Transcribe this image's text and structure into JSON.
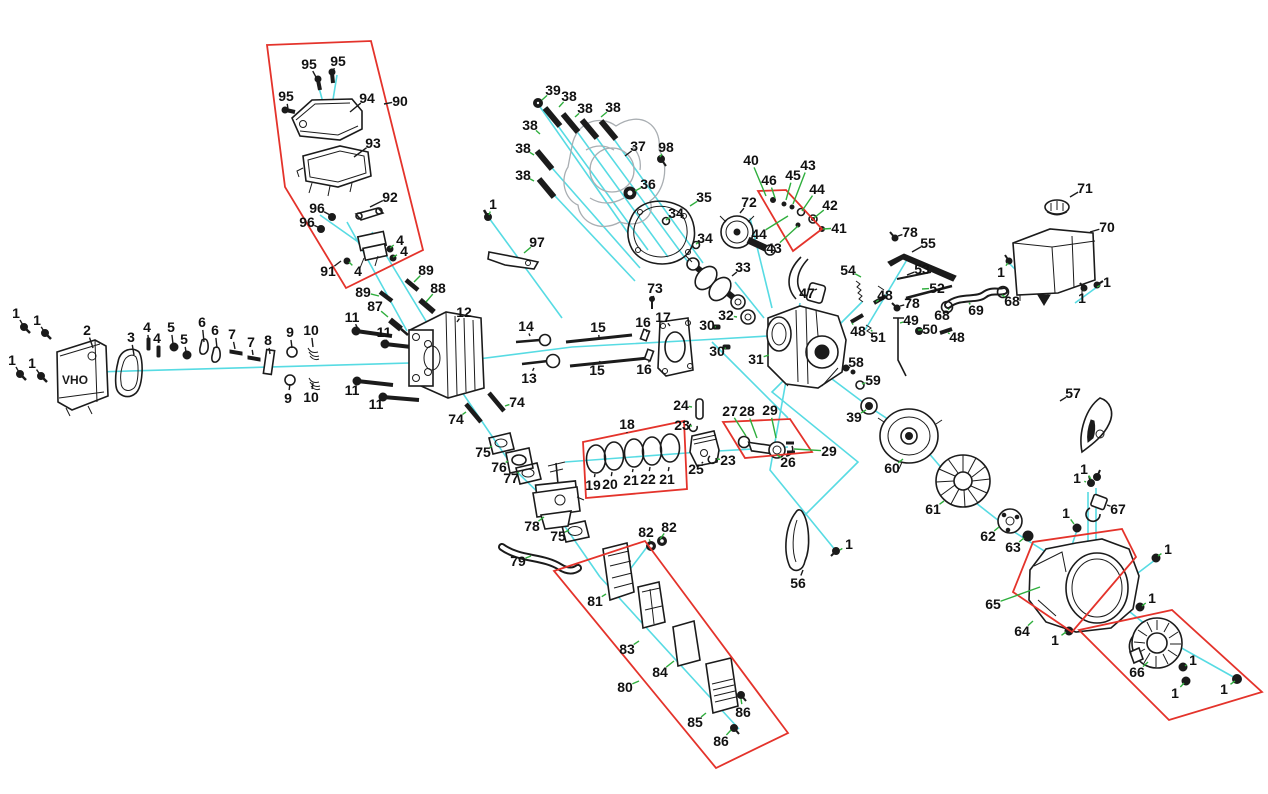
{
  "canvas": {
    "width": 1268,
    "height": 794,
    "background": "#ffffff"
  },
  "colors": {
    "leader_green": "#2fae3d",
    "leader_black": "#1b1b1b",
    "axis_cyan": "#57dbe3",
    "group_red": "#e4332b",
    "label_ink": "#111111"
  },
  "muffler_text": "OHV",
  "labels": [
    {
      "t": "1",
      "x": 16,
      "y": 313,
      "lx": 24,
      "ly": 327,
      "c": "k"
    },
    {
      "t": "1",
      "x": 37,
      "y": 320,
      "lx": 45,
      "ly": 333,
      "c": "k"
    },
    {
      "t": "1",
      "x": 12,
      "y": 360,
      "lx": 20,
      "ly": 374,
      "c": "k"
    },
    {
      "t": "1",
      "x": 32,
      "y": 363,
      "lx": 41,
      "ly": 376,
      "c": "k"
    },
    {
      "t": "2",
      "x": 87,
      "y": 330,
      "lx": 93,
      "ly": 348,
      "c": "k"
    },
    {
      "t": "3",
      "x": 131,
      "y": 337,
      "lx": 134,
      "ly": 355,
      "c": "k"
    },
    {
      "t": "4",
      "x": 147,
      "y": 327,
      "lx": 149,
      "ly": 344,
      "c": "k"
    },
    {
      "t": "4",
      "x": 157,
      "y": 338,
      "lx": 159,
      "ly": 352,
      "c": "k"
    },
    {
      "t": "5",
      "x": 171,
      "y": 327,
      "lx": 173,
      "ly": 344,
      "c": "k"
    },
    {
      "t": "5",
      "x": 184,
      "y": 339,
      "lx": 186,
      "ly": 352,
      "c": "k"
    },
    {
      "t": "6",
      "x": 202,
      "y": 322,
      "lx": 204,
      "ly": 342,
      "c": "k"
    },
    {
      "t": "6",
      "x": 215,
      "y": 330,
      "lx": 217,
      "ly": 348,
      "c": "k"
    },
    {
      "t": "7",
      "x": 232,
      "y": 334,
      "lx": 235,
      "ly": 349,
      "c": "k"
    },
    {
      "t": "7",
      "x": 251,
      "y": 342,
      "lx": 253,
      "ly": 355,
      "c": "k"
    },
    {
      "t": "8",
      "x": 268,
      "y": 340,
      "lx": 270,
      "ly": 354,
      "c": "k"
    },
    {
      "t": "9",
      "x": 290,
      "y": 332,
      "lx": 292,
      "ly": 348,
      "c": "k"
    },
    {
      "t": "9",
      "x": 288,
      "y": 398,
      "lx": 290,
      "ly": 384,
      "c": "k"
    },
    {
      "t": "10",
      "x": 311,
      "y": 330,
      "lx": 313,
      "ly": 347,
      "c": "k"
    },
    {
      "t": "10",
      "x": 311,
      "y": 397,
      "lx": 313,
      "ly": 383,
      "c": "k"
    },
    {
      "t": "11",
      "x": 352,
      "y": 317,
      "lx": 358,
      "ly": 329,
      "c": "k"
    },
    {
      "t": "11",
      "x": 384,
      "y": 332,
      "lx": 387,
      "ly": 342,
      "c": "k"
    },
    {
      "t": "11",
      "x": 352,
      "y": 390,
      "lx": 359,
      "ly": 382,
      "c": "k"
    },
    {
      "t": "11",
      "x": 376,
      "y": 404,
      "lx": 382,
      "ly": 397,
      "c": "k"
    },
    {
      "t": "87",
      "x": 375,
      "y": 306,
      "lx": 388,
      "ly": 317
    },
    {
      "t": "89",
      "x": 363,
      "y": 292,
      "lx": 379,
      "ly": 296
    },
    {
      "t": "89",
      "x": 426,
      "y": 270,
      "lx": 414,
      "ly": 282
    },
    {
      "t": "88",
      "x": 438,
      "y": 288,
      "lx": 426,
      "ly": 302
    },
    {
      "t": "95",
      "x": 309,
      "y": 64,
      "lx": 317,
      "ly": 79,
      "c": "k"
    },
    {
      "t": "95",
      "x": 338,
      "y": 61,
      "lx": 332,
      "ly": 73,
      "c": "k"
    },
    {
      "t": "95",
      "x": 286,
      "y": 96,
      "lx": 288,
      "ly": 109,
      "c": "k"
    },
    {
      "t": "94",
      "x": 367,
      "y": 98,
      "lx": 350,
      "ly": 112,
      "c": "k"
    },
    {
      "t": "90",
      "x": 400,
      "y": 101,
      "lx": 384,
      "ly": 104,
      "c": "k"
    },
    {
      "t": "93",
      "x": 373,
      "y": 143,
      "lx": 354,
      "ly": 157,
      "c": "k"
    },
    {
      "t": "92",
      "x": 390,
      "y": 197,
      "lx": 370,
      "ly": 207,
      "c": "k"
    },
    {
      "t": "96",
      "x": 317,
      "y": 208,
      "lx": 330,
      "ly": 215,
      "c": "k"
    },
    {
      "t": "96",
      "x": 307,
      "y": 222,
      "lx": 320,
      "ly": 228,
      "c": "k"
    },
    {
      "t": "91",
      "x": 328,
      "y": 271,
      "lx": 341,
      "ly": 261,
      "c": "k"
    },
    {
      "t": "4",
      "x": 400,
      "y": 240,
      "lx": 390,
      "ly": 248
    },
    {
      "t": "4",
      "x": 404,
      "y": 251,
      "lx": 393,
      "ly": 257
    },
    {
      "t": "4",
      "x": 358,
      "y": 271,
      "lx": 349,
      "ly": 262
    },
    {
      "t": "1",
      "x": 493,
      "y": 204,
      "lx": 489,
      "ly": 215
    },
    {
      "t": "97",
      "x": 537,
      "y": 242,
      "lx": 524,
      "ly": 253
    },
    {
      "t": "39",
      "x": 553,
      "y": 90,
      "lx": 542,
      "ly": 100
    },
    {
      "t": "38",
      "x": 569,
      "y": 96,
      "lx": 559,
      "ly": 107
    },
    {
      "t": "38",
      "x": 585,
      "y": 108,
      "lx": 575,
      "ly": 117
    },
    {
      "t": "38",
      "x": 613,
      "y": 107,
      "lx": 601,
      "ly": 117
    },
    {
      "t": "38",
      "x": 530,
      "y": 125,
      "lx": 540,
      "ly": 134
    },
    {
      "t": "38",
      "x": 523,
      "y": 148,
      "lx": 534,
      "ly": 155
    },
    {
      "t": "38",
      "x": 523,
      "y": 175,
      "lx": 534,
      "ly": 181
    },
    {
      "t": "37",
      "x": 638,
      "y": 146,
      "lx": 625,
      "ly": 156,
      "c": "k"
    },
    {
      "t": "98",
      "x": 666,
      "y": 147,
      "lx": 660,
      "ly": 157
    },
    {
      "t": "36",
      "x": 648,
      "y": 184,
      "lx": 635,
      "ly": 191
    },
    {
      "t": "34",
      "x": 676,
      "y": 213,
      "lx": 666,
      "ly": 220
    },
    {
      "t": "34",
      "x": 705,
      "y": 238,
      "lx": 696,
      "ly": 244
    },
    {
      "t": "35",
      "x": 704,
      "y": 197,
      "lx": 690,
      "ly": 206
    },
    {
      "t": "72",
      "x": 749,
      "y": 202,
      "lx": 740,
      "ly": 213,
      "c": "k"
    },
    {
      "t": "40",
      "x": 751,
      "y": 160,
      "lx": 766,
      "ly": 196
    },
    {
      "t": "46",
      "x": 769,
      "y": 180,
      "lx": 775,
      "ly": 198
    },
    {
      "t": "45",
      "x": 793,
      "y": 175,
      "lx": 786,
      "ly": 200
    },
    {
      "t": "43",
      "x": 808,
      "y": 165,
      "lx": 793,
      "ly": 204
    },
    {
      "t": "44",
      "x": 817,
      "y": 189,
      "lx": 802,
      "ly": 211
    },
    {
      "t": "42",
      "x": 830,
      "y": 205,
      "lx": 814,
      "ly": 218
    },
    {
      "t": "41",
      "x": 839,
      "y": 228,
      "lx": 823,
      "ly": 229
    },
    {
      "t": "44",
      "x": 759,
      "y": 234,
      "lx": 788,
      "ly": 216
    },
    {
      "t": "43",
      "x": 774,
      "y": 248,
      "lx": 798,
      "ly": 226
    },
    {
      "t": "33",
      "x": 743,
      "y": 267,
      "lx": 732,
      "ly": 276,
      "c": "k"
    },
    {
      "t": "73",
      "x": 655,
      "y": 288,
      "lx": 653,
      "ly": 299,
      "c": "k"
    },
    {
      "t": "47",
      "x": 807,
      "y": 293,
      "lx": 817,
      "ly": 289,
      "c": "k"
    },
    {
      "t": "32",
      "x": 726,
      "y": 315,
      "lx": 737,
      "ly": 317
    },
    {
      "t": "30",
      "x": 707,
      "y": 325,
      "lx": 716,
      "ly": 327
    },
    {
      "t": "30",
      "x": 717,
      "y": 351,
      "lx": 726,
      "ly": 348
    },
    {
      "t": "31",
      "x": 756,
      "y": 359,
      "lx": 769,
      "ly": 355
    },
    {
      "t": "16",
      "x": 643,
      "y": 322,
      "lx": 647,
      "ly": 332,
      "c": "k"
    },
    {
      "t": "17",
      "x": 663,
      "y": 317,
      "lx": 670,
      "ly": 326,
      "c": "k"
    },
    {
      "t": "16",
      "x": 644,
      "y": 369,
      "lx": 650,
      "ly": 360,
      "c": "k"
    },
    {
      "t": "15",
      "x": 598,
      "y": 327,
      "lx": 599,
      "ly": 337,
      "c": "k"
    },
    {
      "t": "15",
      "x": 597,
      "y": 370,
      "lx": 600,
      "ly": 361,
      "c": "k"
    },
    {
      "t": "14",
      "x": 526,
      "y": 326,
      "lx": 530,
      "ly": 336,
      "c": "k"
    },
    {
      "t": "13",
      "x": 529,
      "y": 378,
      "lx": 534,
      "ly": 368,
      "c": "k"
    },
    {
      "t": "12",
      "x": 464,
      "y": 312,
      "lx": 457,
      "ly": 322,
      "c": "k"
    },
    {
      "t": "74",
      "x": 456,
      "y": 419,
      "lx": 466,
      "ly": 412
    },
    {
      "t": "74",
      "x": 517,
      "y": 402,
      "lx": 505,
      "ly": 406
    },
    {
      "t": "75",
      "x": 483,
      "y": 452,
      "lx": 492,
      "ly": 446
    },
    {
      "t": "76",
      "x": 499,
      "y": 467,
      "lx": 508,
      "ly": 461
    },
    {
      "t": "77",
      "x": 511,
      "y": 478,
      "lx": 519,
      "ly": 472
    },
    {
      "t": "78",
      "x": 532,
      "y": 526,
      "lx": 544,
      "ly": 517
    },
    {
      "t": "75",
      "x": 558,
      "y": 536,
      "lx": 569,
      "ly": 530
    },
    {
      "t": "79",
      "x": 518,
      "y": 561,
      "lx": 531,
      "ly": 556
    },
    {
      "t": "82",
      "x": 646,
      "y": 532,
      "lx": 650,
      "ly": 541
    },
    {
      "t": "82",
      "x": 669,
      "y": 527,
      "lx": 660,
      "ly": 539
    },
    {
      "t": "18",
      "x": 627,
      "y": 424,
      "lx": 627,
      "ly": 433,
      "c": "k"
    },
    {
      "t": "24",
      "x": 681,
      "y": 405,
      "lx": 692,
      "ly": 407
    },
    {
      "t": "23",
      "x": 682,
      "y": 425,
      "lx": 692,
      "ly": 426
    },
    {
      "t": "19",
      "x": 593,
      "y": 485,
      "lx": 595,
      "ly": 474,
      "c": "k"
    },
    {
      "t": "20",
      "x": 610,
      "y": 484,
      "lx": 612,
      "ly": 472,
      "c": "k"
    },
    {
      "t": "21",
      "x": 631,
      "y": 480,
      "lx": 633,
      "ly": 469,
      "c": "k"
    },
    {
      "t": "22",
      "x": 648,
      "y": 479,
      "lx": 650,
      "ly": 467,
      "c": "k"
    },
    {
      "t": "21",
      "x": 667,
      "y": 479,
      "lx": 669,
      "ly": 467,
      "c": "k"
    },
    {
      "t": "25",
      "x": 696,
      "y": 469,
      "lx": 703,
      "ly": 462,
      "c": "k"
    },
    {
      "t": "23",
      "x": 728,
      "y": 460,
      "lx": 717,
      "ly": 459
    },
    {
      "t": "27",
      "x": 730,
      "y": 411,
      "lx": 746,
      "ly": 436
    },
    {
      "t": "28",
      "x": 747,
      "y": 411,
      "lx": 757,
      "ly": 438
    },
    {
      "t": "29",
      "x": 770,
      "y": 410,
      "lx": 776,
      "ly": 438
    },
    {
      "t": "29",
      "x": 829,
      "y": 451,
      "lx": 794,
      "ly": 449
    },
    {
      "t": "26",
      "x": 788,
      "y": 462,
      "lx": 777,
      "ly": 455
    },
    {
      "t": "55",
      "x": 928,
      "y": 243,
      "lx": 912,
      "ly": 252,
      "c": "k"
    },
    {
      "t": "78",
      "x": 910,
      "y": 232,
      "lx": 898,
      "ly": 236,
      "c": "k"
    },
    {
      "t": "54",
      "x": 848,
      "y": 270,
      "lx": 861,
      "ly": 277
    },
    {
      "t": "53",
      "x": 922,
      "y": 269,
      "lx": 907,
      "ly": 275,
      "c": "k"
    },
    {
      "t": "52",
      "x": 937,
      "y": 288,
      "lx": 922,
      "ly": 289
    },
    {
      "t": "48",
      "x": 885,
      "y": 295,
      "lx": 876,
      "ly": 302
    },
    {
      "t": "78",
      "x": 912,
      "y": 303,
      "lx": 900,
      "ly": 306,
      "c": "k"
    },
    {
      "t": "49",
      "x": 911,
      "y": 320,
      "lx": 900,
      "ly": 323
    },
    {
      "t": "50",
      "x": 930,
      "y": 329,
      "lx": 918,
      "ly": 330
    },
    {
      "t": "51",
      "x": 878,
      "y": 337,
      "lx": 871,
      "ly": 330
    },
    {
      "t": "48",
      "x": 858,
      "y": 331,
      "lx": 852,
      "ly": 323
    },
    {
      "t": "48",
      "x": 957,
      "y": 337,
      "lx": 948,
      "ly": 333
    },
    {
      "t": "68",
      "x": 942,
      "y": 315,
      "lx": 949,
      "ly": 309
    },
    {
      "t": "69",
      "x": 976,
      "y": 310,
      "lx": 969,
      "ly": 303
    },
    {
      "t": "68",
      "x": 1012,
      "y": 301,
      "lx": 1002,
      "ly": 295
    },
    {
      "t": "1",
      "x": 1001,
      "y": 272,
      "lx": 1008,
      "ly": 263
    },
    {
      "t": "71",
      "x": 1085,
      "y": 188,
      "lx": 1070,
      "ly": 197,
      "c": "k"
    },
    {
      "t": "70",
      "x": 1107,
      "y": 227,
      "lx": 1090,
      "ly": 232,
      "c": "k"
    },
    {
      "t": "1",
      "x": 1107,
      "y": 282,
      "lx": 1097,
      "ly": 287
    },
    {
      "t": "1",
      "x": 1082,
      "y": 298,
      "lx": 1084,
      "ly": 290
    },
    {
      "t": "57",
      "x": 1073,
      "y": 393,
      "lx": 1060,
      "ly": 401,
      "c": "k"
    },
    {
      "t": "58",
      "x": 856,
      "y": 362,
      "lx": 849,
      "ly": 368,
      "c": "k"
    },
    {
      "t": "59",
      "x": 873,
      "y": 380,
      "lx": 862,
      "ly": 384
    },
    {
      "t": "39",
      "x": 854,
      "y": 417,
      "lx": 866,
      "ly": 410
    },
    {
      "t": "60",
      "x": 892,
      "y": 468,
      "lx": 903,
      "ly": 459
    },
    {
      "t": "61",
      "x": 933,
      "y": 509,
      "lx": 944,
      "ly": 501
    },
    {
      "t": "62",
      "x": 988,
      "y": 536,
      "lx": 999,
      "ly": 527
    },
    {
      "t": "63",
      "x": 1013,
      "y": 547,
      "lx": 1024,
      "ly": 538
    },
    {
      "t": "56",
      "x": 798,
      "y": 583,
      "lx": 803,
      "ly": 570,
      "c": "k"
    },
    {
      "t": "1",
      "x": 849,
      "y": 544,
      "lx": 840,
      "ly": 550
    },
    {
      "t": "80",
      "x": 625,
      "y": 687,
      "lx": 639,
      "ly": 681
    },
    {
      "t": "81",
      "x": 595,
      "y": 601,
      "lx": 606,
      "ly": 594
    },
    {
      "t": "83",
      "x": 627,
      "y": 649,
      "lx": 639,
      "ly": 641
    },
    {
      "t": "84",
      "x": 660,
      "y": 672,
      "lx": 674,
      "ly": 661
    },
    {
      "t": "85",
      "x": 695,
      "y": 722,
      "lx": 706,
      "ly": 713
    },
    {
      "t": "86",
      "x": 743,
      "y": 712,
      "lx": 741,
      "ly": 699
    },
    {
      "t": "86",
      "x": 721,
      "y": 741,
      "lx": 731,
      "ly": 730
    },
    {
      "t": "1",
      "x": 1084,
      "y": 469,
      "lx": 1091,
      "ly": 479
    },
    {
      "t": "1",
      "x": 1077,
      "y": 478,
      "lx": 1086,
      "ly": 482
    },
    {
      "t": "67",
      "x": 1118,
      "y": 509,
      "lx": 1107,
      "ly": 505,
      "c": "k"
    },
    {
      "t": "1",
      "x": 1066,
      "y": 513,
      "lx": 1074,
      "ly": 524
    },
    {
      "t": "1",
      "x": 1168,
      "y": 549,
      "lx": 1158,
      "ly": 556
    },
    {
      "t": "65",
      "x": 993,
      "y": 604,
      "lx": 1040,
      "ly": 587
    },
    {
      "t": "64",
      "x": 1022,
      "y": 631,
      "lx": 1033,
      "ly": 621
    },
    {
      "t": "1",
      "x": 1055,
      "y": 640,
      "lx": 1066,
      "ly": 632
    },
    {
      "t": "66",
      "x": 1137,
      "y": 672,
      "lx": 1148,
      "ly": 662
    },
    {
      "t": "1",
      "x": 1152,
      "y": 598,
      "lx": 1142,
      "ly": 606
    },
    {
      "t": "1",
      "x": 1193,
      "y": 660,
      "lx": 1185,
      "ly": 666
    },
    {
      "t": "1",
      "x": 1175,
      "y": 693,
      "lx": 1184,
      "ly": 683
    },
    {
      "t": "1",
      "x": 1224,
      "y": 689,
      "lx": 1235,
      "ly": 681
    }
  ],
  "red_boxes": [
    {
      "points": "267,45 371,41 423,250 346,288 285,187"
    },
    {
      "points": "758,191 786,190 822,229 793,251"
    },
    {
      "points": "583,442 684,421 687,489 586,498"
    },
    {
      "points": "723,422 790,419 812,452 745,458"
    },
    {
      "points": "554,571 645,541 788,733 716,768"
    },
    {
      "points": "1013,592 1033,542 1122,529 1136,557 1072,632"
    },
    {
      "points": "1079,630 1172,610 1262,692 1169,720"
    }
  ],
  "cyan_lines": [
    {
      "points": "95,372 445,362"
    },
    {
      "points": "447,363 572,347 700,340 768,336"
    },
    {
      "points": "800,355 868,406 915,437 962,492 1008,528 1090,580 1160,636 1237,679"
    },
    {
      "points": "538,104 628,233"
    },
    {
      "points": "545,108 648,250"
    },
    {
      "points": "565,115 668,257"
    },
    {
      "points": "585,122 688,262"
    },
    {
      "points": "603,124 703,263"
    },
    {
      "points": "538,152 640,268"
    },
    {
      "points": "540,180 635,281"
    },
    {
      "points": "489,218 562,318"
    },
    {
      "points": "372,232 432,331"
    },
    {
      "points": "347,222 407,331"
    },
    {
      "points": "320,215 371,251"
    },
    {
      "points": "318,84 325,110"
    },
    {
      "points": "337,75 331,112"
    },
    {
      "points": "565,462 700,452 788,447"
    },
    {
      "points": "600,577 739,729"
    },
    {
      "points": "447,370 515,470 548,502 600,577"
    },
    {
      "points": "800,303 770,470 836,551"
    },
    {
      "points": "862,302 772,392 858,462 800,520"
    },
    {
      "points": "712,342 788,418"
    },
    {
      "points": "1009,263 1042,297"
    },
    {
      "points": "1097,287 1075,303"
    },
    {
      "points": "908,258 865,330"
    },
    {
      "points": "750,218 772,308"
    },
    {
      "points": "735,282 764,318"
    },
    {
      "points": "650,543 628,572"
    },
    {
      "points": "1088,492 1088,553"
    },
    {
      "points": "1096,488 1096,556"
    },
    {
      "points": "1077,530 1072,545"
    },
    {
      "points": "1155,560 1122,585"
    }
  ]
}
